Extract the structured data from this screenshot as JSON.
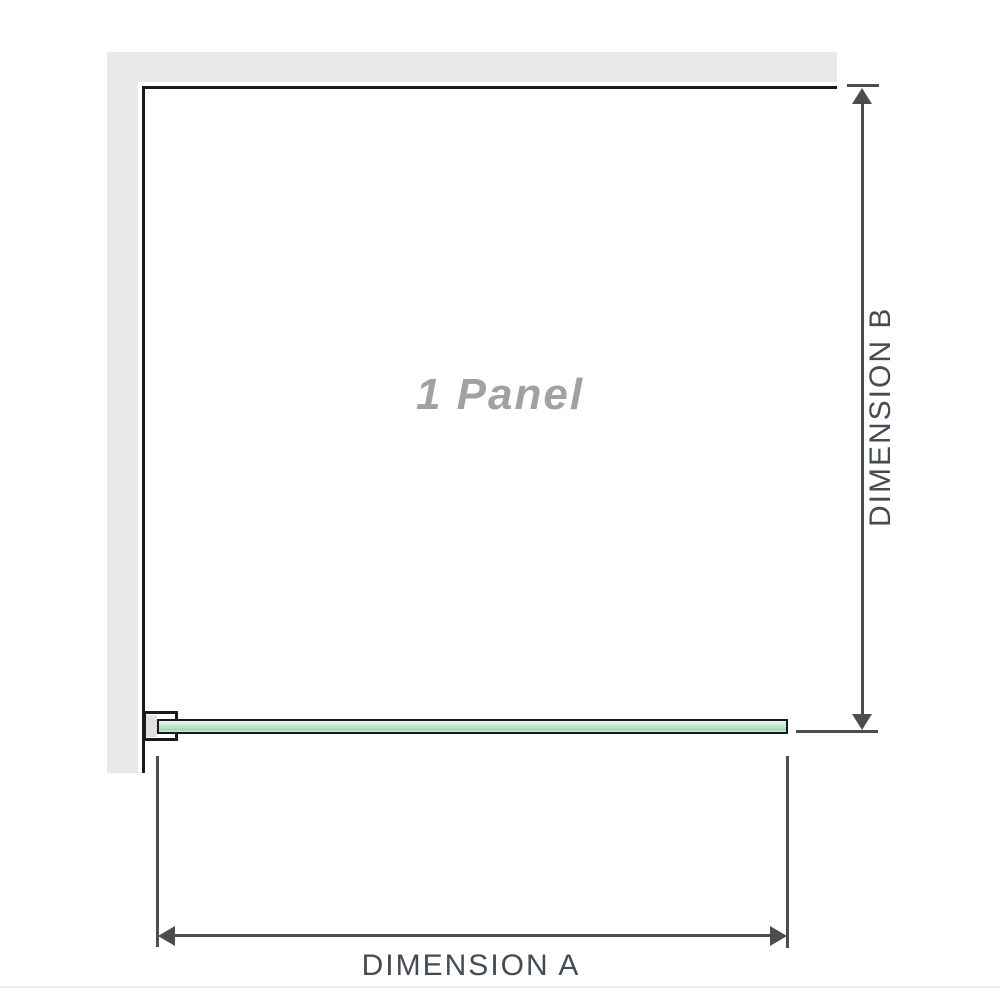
{
  "diagram": {
    "panel_label": "1 Panel",
    "dimension_a_label": "DIMENSION A",
    "dimension_b_label": "DIMENSION B"
  },
  "colors": {
    "wall": "#e9e9e9",
    "outline": "#1a1a1a",
    "dimension": "#4d4d4d",
    "label-gray": "#a1a1a1",
    "dim-text": "#454b54",
    "glass-border": "#1a1a1a",
    "glass-light": "#e9f8ef",
    "glass-mid": "#9fd8ba",
    "glass-soft": "#cdebd8",
    "bracket-fill": "#e0e0e0",
    "divider": "#ecebe8"
  }
}
